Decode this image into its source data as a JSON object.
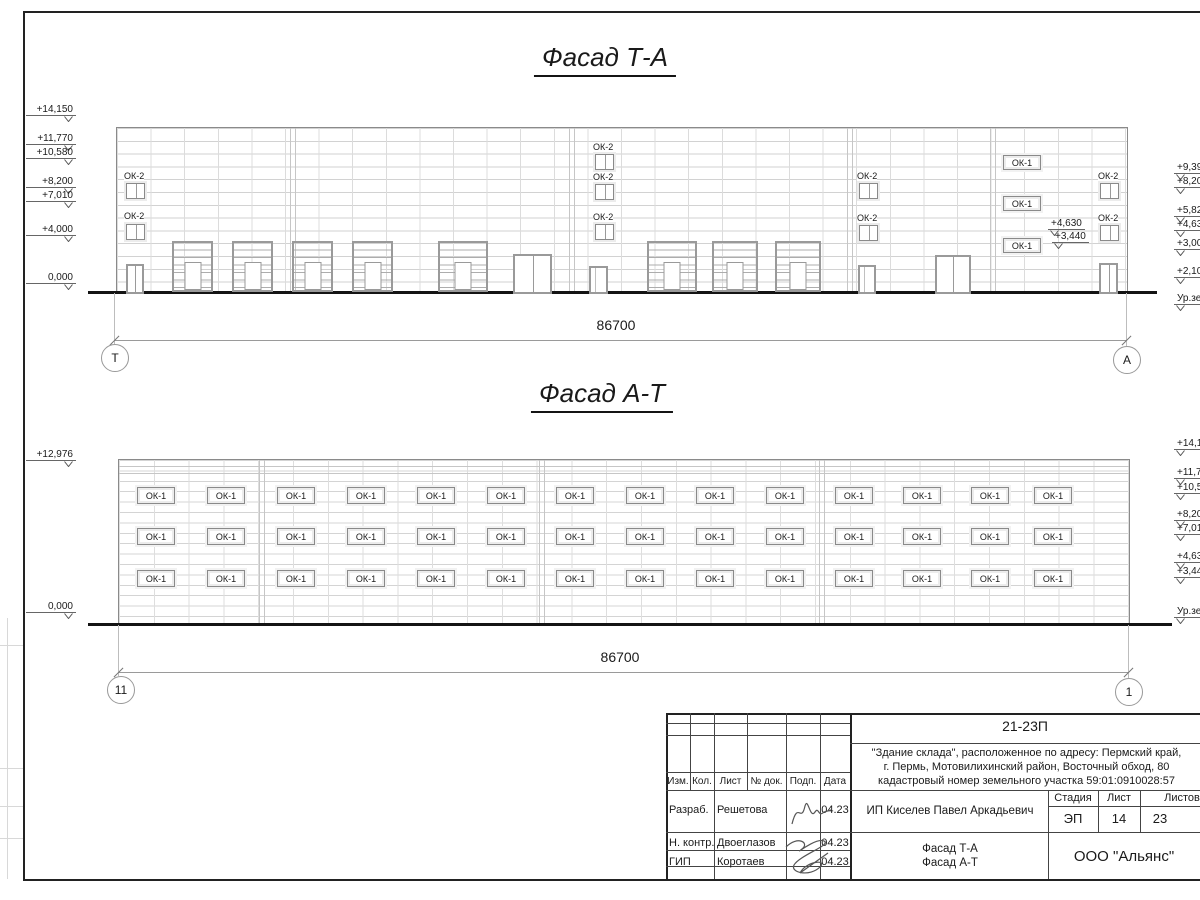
{
  "drawing": {
    "facade_ta": {
      "title": "Фасад Т-А",
      "dimension": "86700",
      "ok2_label": "ОК-2",
      "ok1_label": "ОК-1",
      "left_marks": [
        {
          "text": "+14,150",
          "y": 104
        },
        {
          "text": "+11,770",
          "y": 133
        },
        {
          "text": "+10,580",
          "y": 147
        },
        {
          "text": "+8,200",
          "y": 176
        },
        {
          "text": "+7,010",
          "y": 190
        },
        {
          "text": "+4,000",
          "y": 224
        },
        {
          "text": "0,000",
          "y": 272
        }
      ],
      "right_marks": [
        {
          "text": "+9,39",
          "y": 162
        },
        {
          "text": "+8,20",
          "y": 176
        },
        {
          "text": "+5,82",
          "y": 205
        },
        {
          "text": "+4,63",
          "y": 219
        },
        {
          "text": "+3,000",
          "y": 238
        },
        {
          "text": "+2,10",
          "y": 266
        },
        {
          "text": "Ур.зе",
          "y": 293
        }
      ],
      "inner_marks": [
        {
          "text": "+4,630",
          "x": 1048,
          "y": 218
        },
        {
          "text": "+3,440",
          "x": 1052,
          "y": 231
        }
      ],
      "ok2_labels": [
        {
          "x": 124,
          "y": 171
        },
        {
          "x": 124,
          "y": 211
        },
        {
          "x": 593,
          "y": 142
        },
        {
          "x": 593,
          "y": 172
        },
        {
          "x": 593,
          "y": 212
        },
        {
          "x": 857,
          "y": 171
        },
        {
          "x": 857,
          "y": 213
        },
        {
          "x": 1098,
          "y": 171
        },
        {
          "x": 1098,
          "y": 213
        }
      ],
      "ok2_windows": [
        {
          "x": 126,
          "y": 183
        },
        {
          "x": 126,
          "y": 224
        },
        {
          "x": 595,
          "y": 154
        },
        {
          "x": 595,
          "y": 184
        },
        {
          "x": 595,
          "y": 224
        },
        {
          "x": 859,
          "y": 183
        },
        {
          "x": 859,
          "y": 225
        },
        {
          "x": 1100,
          "y": 183
        },
        {
          "x": 1100,
          "y": 225
        }
      ],
      "ok1_boxes": [
        {
          "x": 1003,
          "y": 155
        },
        {
          "x": 1003,
          "y": 196
        },
        {
          "x": 1003,
          "y": 238
        }
      ],
      "gates": [
        {
          "x": 172,
          "y": 241,
          "w": 41,
          "h": 51
        },
        {
          "x": 232,
          "y": 241,
          "w": 41,
          "h": 51
        },
        {
          "x": 292,
          "y": 241,
          "w": 41,
          "h": 51
        },
        {
          "x": 352,
          "y": 241,
          "w": 41,
          "h": 51
        },
        {
          "x": 438,
          "y": 241,
          "w": 50,
          "h": 51
        },
        {
          "x": 647,
          "y": 241,
          "w": 50,
          "h": 51
        },
        {
          "x": 712,
          "y": 241,
          "w": 46,
          "h": 51
        },
        {
          "x": 775,
          "y": 241,
          "w": 46,
          "h": 51
        }
      ],
      "doors": [
        {
          "x": 126,
          "y": 264,
          "w": 18,
          "h": 28,
          "v": "double"
        },
        {
          "x": 513,
          "y": 254,
          "w": 39,
          "h": 38,
          "v": "double"
        },
        {
          "x": 589,
          "y": 266,
          "w": 19,
          "h": 26,
          "v": "single"
        },
        {
          "x": 858,
          "y": 265,
          "w": 18,
          "h": 27,
          "v": "single"
        },
        {
          "x": 935,
          "y": 255,
          "w": 36,
          "h": 37,
          "v": "double"
        },
        {
          "x": 1099,
          "y": 263,
          "w": 19,
          "h": 29,
          "v": "double"
        }
      ],
      "axes": [
        {
          "label": "Т",
          "cx": 114,
          "cy": 357
        },
        {
          "label": "А",
          "cx": 1126,
          "cy": 359
        }
      ]
    },
    "facade_at": {
      "title": "Фасад А-Т",
      "dimension": "86700",
      "window_label": "ОК-1",
      "left_marks": [
        {
          "text": "+12,976",
          "y": 449
        },
        {
          "text": "0,000",
          "y": 601
        }
      ],
      "right_marks": [
        {
          "text": "+14,15",
          "y": 438
        },
        {
          "text": "+11,77",
          "y": 467
        },
        {
          "text": "+10,58",
          "y": 482
        },
        {
          "text": "+8,20",
          "y": 509
        },
        {
          "text": "+7,01",
          "y": 523
        },
        {
          "text": "+4,63",
          "y": 551
        },
        {
          "text": "+3,44",
          "y": 566
        },
        {
          "text": "Ур.зем",
          "y": 606
        }
      ],
      "window_cols_x": [
        137,
        207,
        277,
        347,
        417,
        487,
        556,
        626,
        696,
        766,
        835,
        903,
        971,
        1034
      ],
      "window_rows_y": [
        487,
        528,
        570
      ],
      "axes": [
        {
          "label": "11",
          "cx": 120,
          "cy": 689
        },
        {
          "label": "1",
          "cx": 1128,
          "cy": 691
        }
      ]
    },
    "titleblock": {
      "code": "21-23П",
      "address_lines": [
        "\"Здание склада\", расположенное по адресу: Пермский край,",
        "г. Пермь, Мотовилихинский район, Восточный обход, 80",
        "кадастровый номер земельного участка 59:01:0910028:57"
      ],
      "col_headers": [
        "Изм.",
        "Кол.",
        "Лист",
        "№ док.",
        "Подп.",
        "Дата"
      ],
      "rows": [
        {
          "role": "Разраб.",
          "name": "Решетова",
          "date": "04.23"
        },
        {
          "role": "Н. контр.",
          "name": "Двоеглазов",
          "date": "04.23"
        },
        {
          "role": "ГИП",
          "name": "Коротаев",
          "date": "04.23"
        }
      ],
      "client": "ИП Киселев Павел Аркадьевич",
      "stage_label": "Стадия",
      "sheet_label": "Лист",
      "sheets_label": "Листов",
      "stage": "ЭП",
      "sheet": "14",
      "sheets": "23",
      "subject_lines": [
        "Фасад Т-А",
        "Фасад А-Т"
      ],
      "company": "ООО \"Альянс\""
    }
  }
}
